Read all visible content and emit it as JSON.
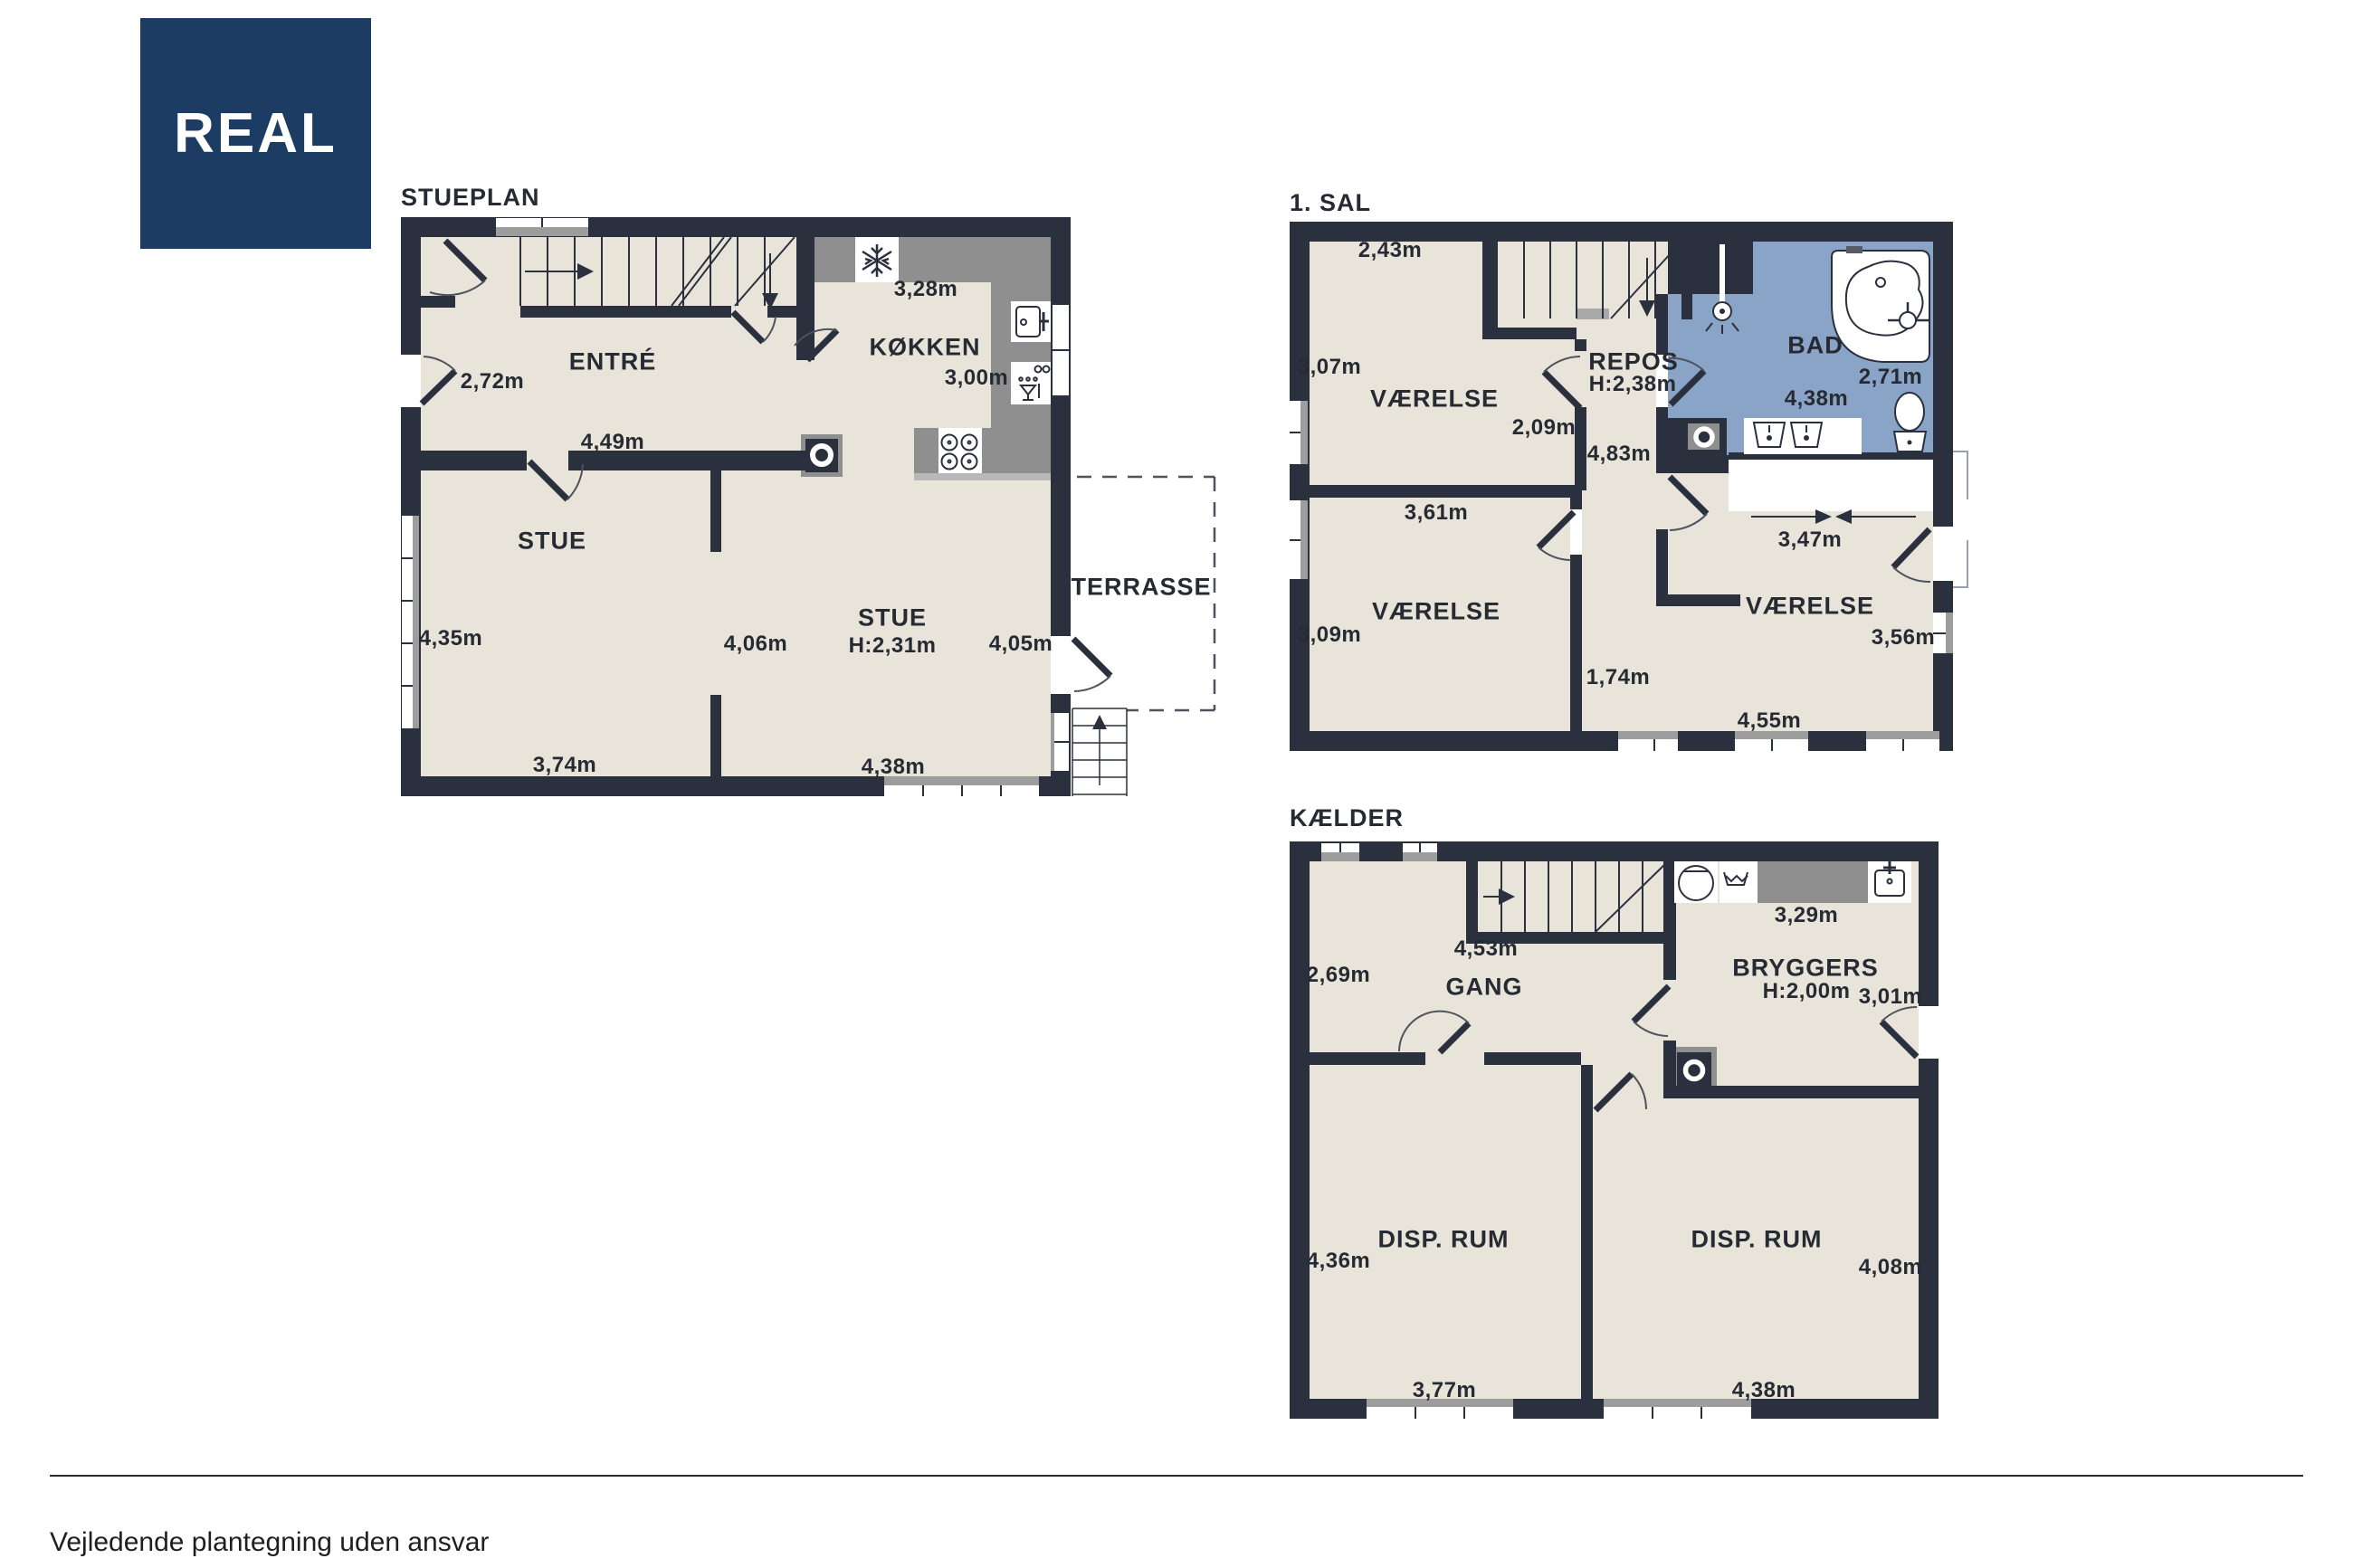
{
  "logo": {
    "text": "REAL"
  },
  "colors": {
    "wall": "#2a303d",
    "floor": "#e9e4da",
    "bath_blue": "#8aa4c7",
    "counter_gray": "#8f8f8f",
    "logo_navy": "#1d3c63"
  },
  "icons": {
    "wood_stove": "ring-in-square",
    "fridge": "snowflake",
    "stove": "four-burners",
    "kitchen_sink": "basin-with-tap",
    "dishwasher": "glass-and-dots",
    "washing_machine": "drum-circle",
    "laundry_sink": "wave-basin",
    "shower": "shower-head",
    "bathtub": "corner-tub",
    "toilet": "bowl-and-tank",
    "stairs": "treads-with-arrow"
  },
  "stueplan": {
    "title": "STUEPLAN",
    "entre": {
      "name": "ENTRÉ",
      "door_width": "2,72m",
      "width": "4,49m"
    },
    "kokken": {
      "name": "KØKKEN",
      "width": "3,28m",
      "depth": "3,00m"
    },
    "stue_left": {
      "name": "STUE",
      "left": "4,35m",
      "bottom": "3,74m"
    },
    "stue_right": {
      "name": "STUE",
      "ceiling": "H:2,31m",
      "left": "4,06m",
      "right": "4,05m",
      "bottom": "4,38m"
    },
    "terrasse": {
      "name": "TERRASSE"
    }
  },
  "sal": {
    "title": "1. SAL",
    "vaerelse_nw": {
      "name": "VÆRELSE",
      "top": "2,43m",
      "left": "3,07m"
    },
    "repos": {
      "name": "REPOS",
      "ceiling": "H:2,38m",
      "width": "2,09m",
      "length": "4,83m"
    },
    "bad": {
      "name": "BAD",
      "width": "4,38m",
      "depth": "2,71m"
    },
    "vaerelse_sw": {
      "name": "VÆRELSE",
      "top": "3,61m",
      "left": "3,09m"
    },
    "hall": {
      "width": "1,74m"
    },
    "vaerelse_e": {
      "name": "VÆRELSE",
      "span": "3,47m",
      "right": "3,56m",
      "bottom": "4,55m"
    }
  },
  "kaelder": {
    "title": "KÆLDER",
    "gang": {
      "name": "GANG",
      "left": "2,69m",
      "top": "4,53m"
    },
    "bryggers": {
      "name": "BRYGGERS",
      "ceiling": "H:2,00m",
      "top": "3,29m",
      "right": "3,01m"
    },
    "disp_rum_left": {
      "name": "DISP. RUM",
      "left": "4,36m",
      "bottom": "3,77m"
    },
    "disp_rum_right": {
      "name": "DISP. RUM",
      "right": "4,08m",
      "bottom": "4,38m"
    }
  },
  "footer": {
    "disclaimer": "Vejledende plantegning uden ansvar"
  }
}
